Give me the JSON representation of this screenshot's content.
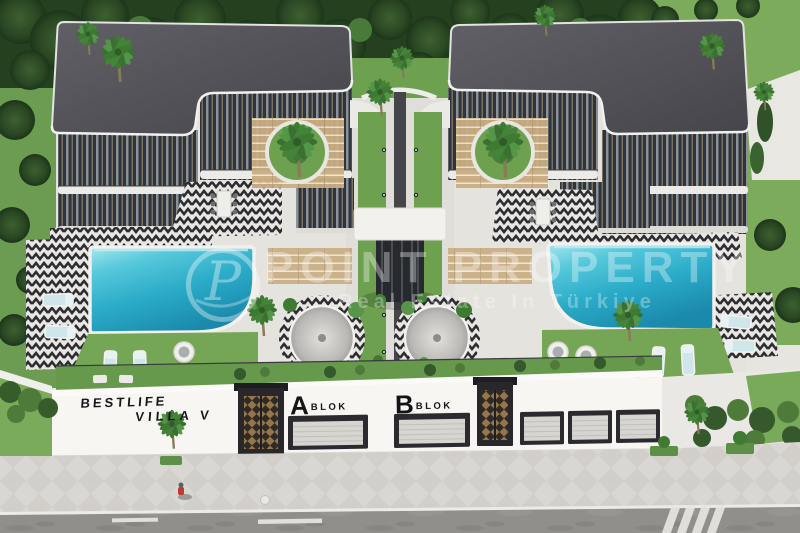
{
  "signage": {
    "estate_line1": "BESTLIFE",
    "estate_line2": "VILLA V",
    "block_a_letter": "A",
    "block_a_label": "BLOK",
    "block_b_letter": "B",
    "block_b_label": "BLOK"
  },
  "watermark": {
    "logo_letter": "P",
    "title": "POINT PROPERTY",
    "subtitle": "Real Estate In Türkiye"
  },
  "palette": {
    "roof": "#54545a",
    "facade": "#2f343c",
    "pool_water": "#2fb4cf",
    "pool_rim": "#9fe4ec",
    "lawn": "#6fa052",
    "trees": "#24401f",
    "deck_white": "#f2f1ee",
    "tile_dark": "#2c2c31",
    "tile_light": "#e8e7e3",
    "wall_white": "#f7f6f3",
    "sidewalk": "#d9d7d3",
    "road": "#908f8b",
    "sign_text": "#17171a",
    "gate_wood": "#96754c",
    "watermark_white": "rgba(255,255,255,0.34)"
  }
}
